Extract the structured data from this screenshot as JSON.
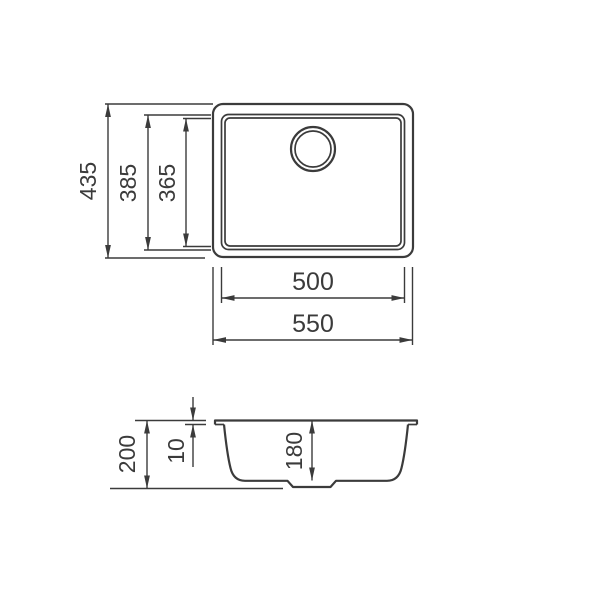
{
  "drawing": {
    "background": "#ffffff",
    "line_color": "#3b3b3b",
    "top_view": {
      "overall_width": "550",
      "inner_width": "500",
      "overall_height": "435",
      "bowl_outer_height": "385",
      "bowl_inner_height": "365"
    },
    "section_view": {
      "overall_depth": "200",
      "rim_thickness": "10",
      "bowl_depth": "180"
    }
  }
}
